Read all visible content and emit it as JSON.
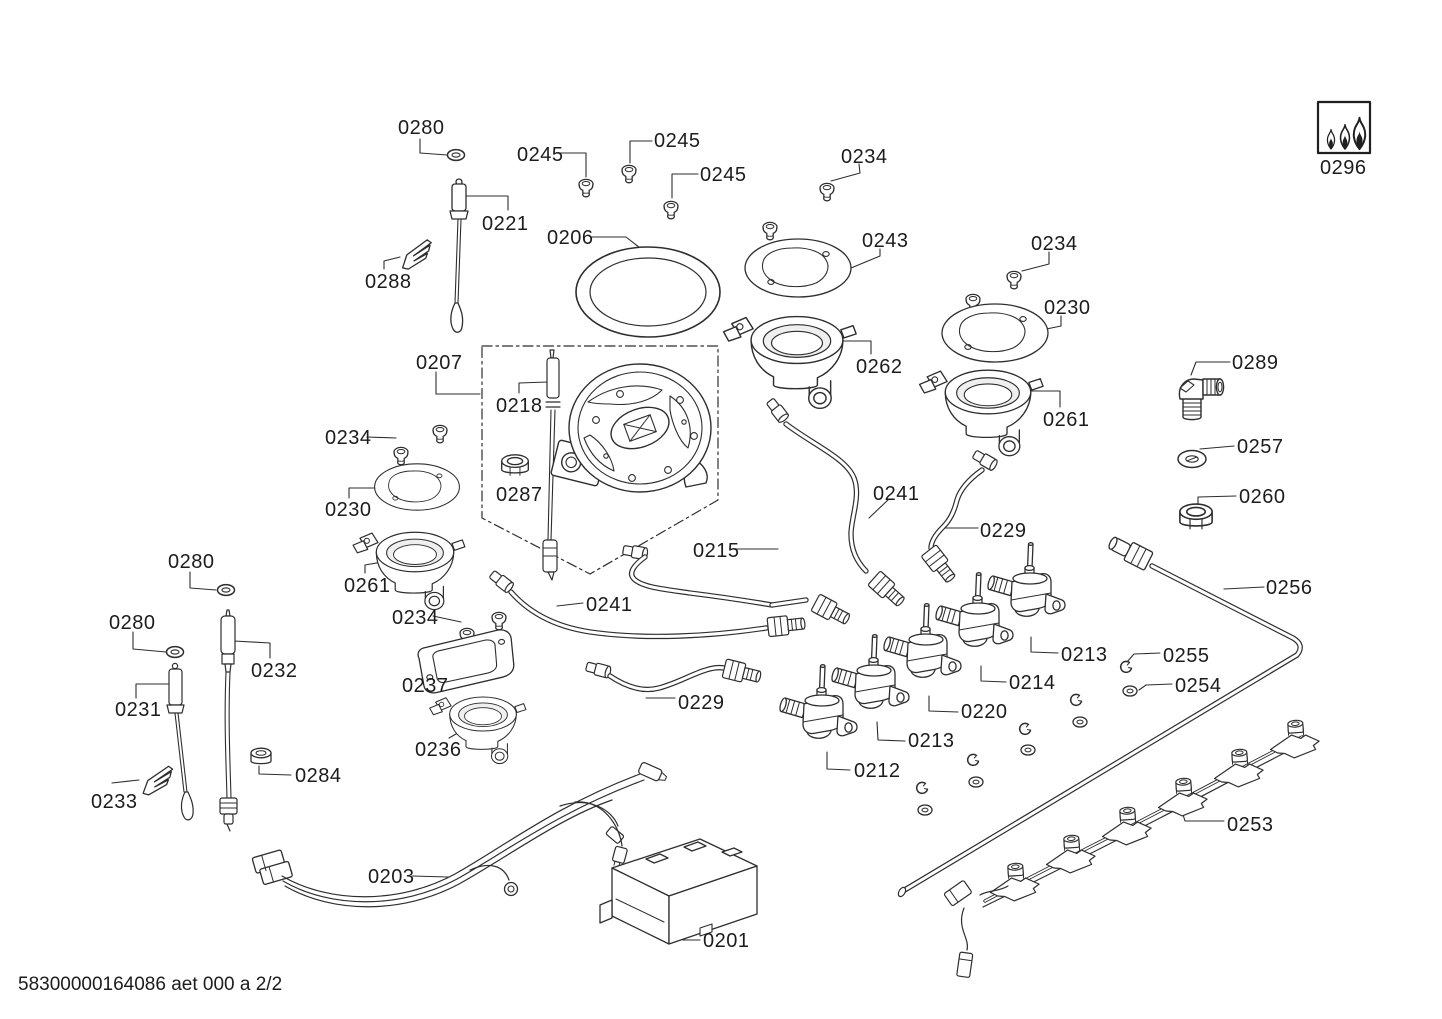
{
  "document": {
    "footer": "58300000164086 aet 000 a 2/2",
    "page_indicator": "2/2",
    "ink_color": "#2e2e2e",
    "background_color": "#ffffff"
  },
  "parts": {
    "0201": "0201",
    "0203": "0203",
    "0206": "0206",
    "0207": "0207",
    "0212": "0212",
    "0213": "0213",
    "0214": "0214",
    "0215": "0215",
    "0218": "0218",
    "0220": "0220",
    "0221": "0221",
    "0229": "0229",
    "0230": "0230",
    "0231": "0231",
    "0232": "0232",
    "0233": "0233",
    "0234": "0234",
    "0236": "0236",
    "0237": "0237",
    "0241": "0241",
    "0243": "0243",
    "0245": "0245",
    "0253": "0253",
    "0254": "0254",
    "0255": "0255",
    "0256": "0256",
    "0257": "0257",
    "0260": "0260",
    "0261": "0261",
    "0262": "0262",
    "0280": "0280",
    "0284": "0284",
    "0287": "0287",
    "0288": "0288",
    "0289": "0289",
    "0296": "0296"
  }
}
